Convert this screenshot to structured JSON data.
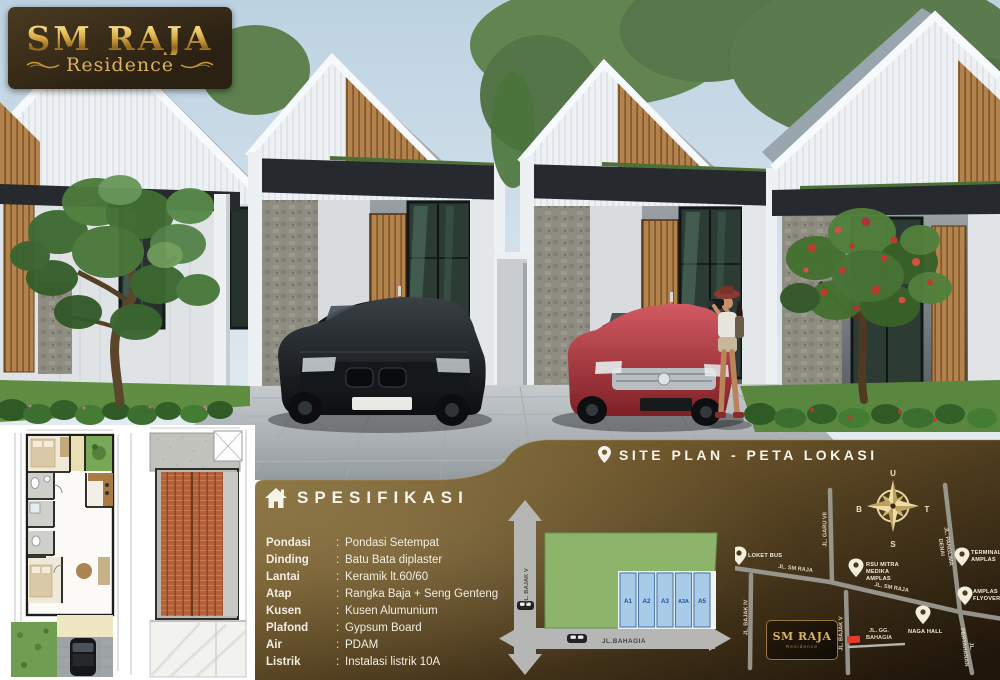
{
  "logo": {
    "title": "SM RAJA",
    "subtitle": "Residence"
  },
  "spesifikasi": {
    "heading": "SPESIFIKASI",
    "separator": ":",
    "items": [
      {
        "label": "Pondasi",
        "value": "Pondasi Setempat"
      },
      {
        "label": "Dinding",
        "value": "Batu Bata diplaster"
      },
      {
        "label": "Lantai",
        "value": "Keramik lt.60/60"
      },
      {
        "label": "Atap",
        "value": "Rangka Baja + Seng Genteng"
      },
      {
        "label": "Kusen",
        "value": "Kusen Alumunium"
      },
      {
        "label": "Plafond",
        "value": "Gypsum Board"
      },
      {
        "label": "Air",
        "value": "PDAM"
      },
      {
        "label": "Listrik",
        "value": "Instalasi listrik 10A"
      }
    ]
  },
  "siteplan": {
    "heading": "SITE PLAN - PETA LOKASI",
    "lots": [
      "A1",
      "A2",
      "A3",
      "A3A",
      "A5"
    ],
    "road_vertical": "JL. BAJAK V",
    "road_horizontal": "JL.BAHAGIA"
  },
  "map": {
    "compass": {
      "n": "U",
      "e": "T",
      "s": "S",
      "w": "B"
    },
    "pins": {
      "loket": "LOKET BUS",
      "rsu": "RSU MITRA MEDIKA AMPLAS",
      "terminal": "TERMINAL AMPLAS",
      "flyover": "AMPLAS FLYOVER",
      "naga": "NAGA HALL"
    },
    "streets": {
      "sm_raja_1": "JL. SM RAJA",
      "sm_raja_2": "JL. SM RAJA",
      "garu": "JL. GARU VII",
      "panglima": "JL. PANGLIMA DENAI",
      "bajak4": "JL. BAJAK IV",
      "bajak5": "JL. BAJAK V",
      "pertahanan": "JL. PERTAHANAN",
      "gg_bahagia": "JL. GG. BAHAGIA"
    },
    "logo": {
      "title": "SM RAJA",
      "subtitle": "Residence"
    }
  },
  "colors": {
    "panel_gold": "#6f5c31",
    "accent_gold": "#d9b45a",
    "lot_blue": "#a8cbe8",
    "siteplan_green": "#8cb56b",
    "red_marker": "#e23b2e"
  }
}
